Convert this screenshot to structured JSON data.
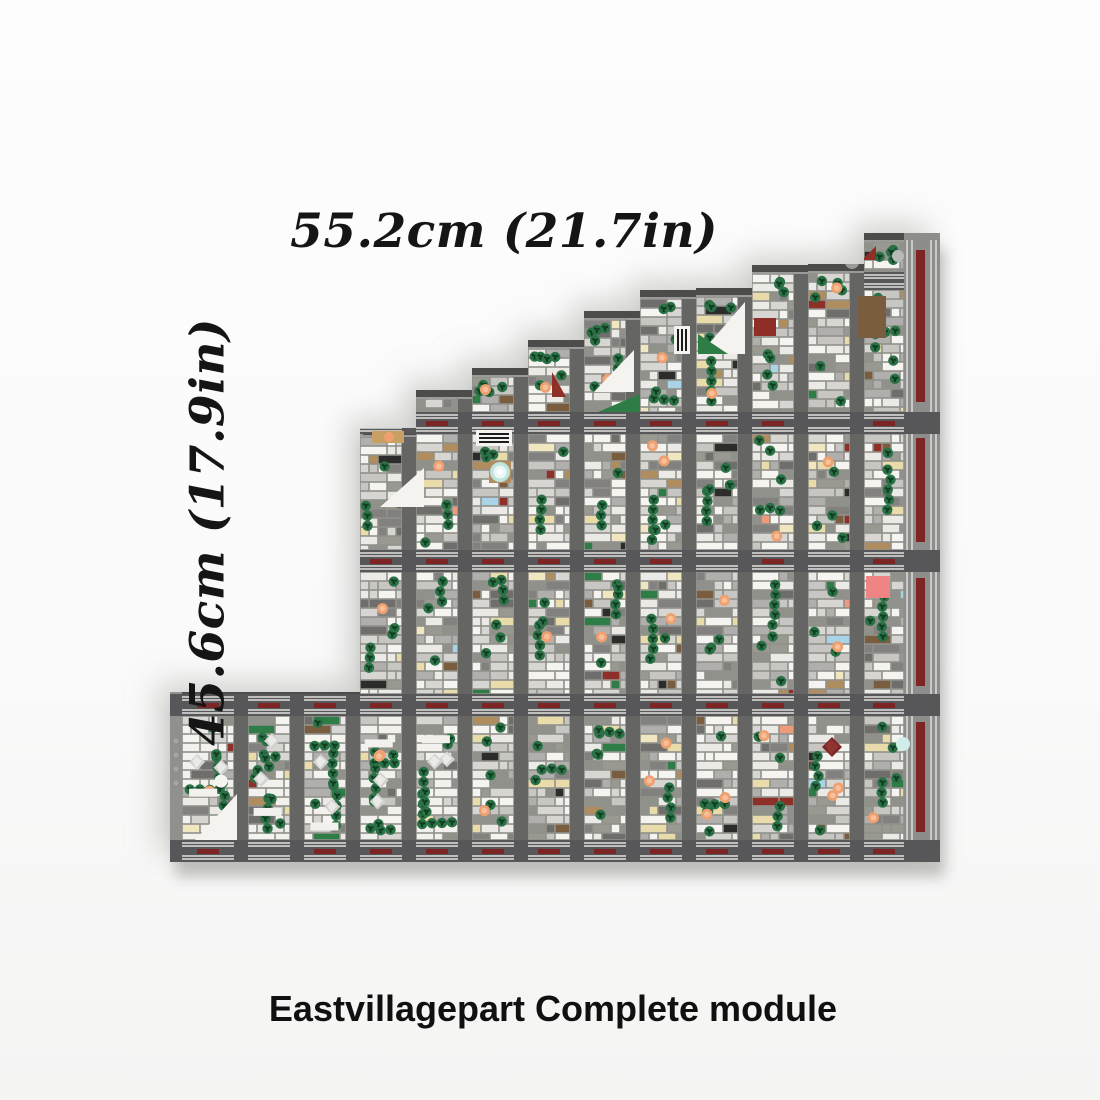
{
  "labels": {
    "width_label": "55.2cm (21.7in)",
    "height_label": "45.6cm (17.9in)",
    "caption": "Eastvillagepart Complete module"
  },
  "model": {
    "description": "Top-down render of stair-stepped LEGO city module with gray streets, white building roofs, green trees, orange dots, red accents",
    "seed": 20,
    "bottom": 862,
    "block_w": 42,
    "street_w": 14,
    "band_h": 22,
    "bands": [
      412,
      550,
      694,
      840
    ],
    "units": [
      {
        "x": 360,
        "w": 56,
        "top": 428
      },
      {
        "x": 416,
        "w": 56,
        "top": 390
      },
      {
        "x": 472,
        "w": 56,
        "top": 368
      },
      {
        "x": 528,
        "w": 56,
        "top": 340
      },
      {
        "x": 584,
        "w": 56,
        "top": 311
      },
      {
        "x": 640,
        "w": 56,
        "top": 290
      },
      {
        "x": 696,
        "w": 56,
        "top": 288
      },
      {
        "x": 752,
        "w": 56,
        "top": 265
      },
      {
        "x": 808,
        "w": 56,
        "top": 264
      },
      {
        "x": 864,
        "w": 76,
        "top": 233
      }
    ],
    "mini_band": {
      "col": 9,
      "y": 272,
      "h": 18
    },
    "extension": {
      "x": 170,
      "w": 190,
      "top": 692,
      "streets": [
        234,
        290,
        346
      ],
      "blocks": [
        [
          182,
          52
        ],
        [
          248,
          42
        ],
        [
          304,
          42
        ]
      ],
      "studs_y": [
        741,
        755,
        769,
        783
      ]
    },
    "platform": {
      "x": 904,
      "w": 36,
      "stripes": [
        906,
        911,
        930,
        935
      ]
    },
    "red_strips": {
      "x": 916,
      "w": 9,
      "segments": [
        [
          250,
          402
        ],
        [
          438,
          542
        ],
        [
          578,
          686
        ],
        [
          722,
          832
        ]
      ]
    },
    "park_max_x": 470,
    "palette": {
      "street": "#656563",
      "street_dark": "#57575a",
      "step_top": "#4c4c4a",
      "step_edge": "#9b9b99",
      "sidewalk": "#8e8e8c",
      "cell_base": "#91918b",
      "stripe": "#bfbfbd",
      "red_bar": "#7c2524",
      "red": "#8e2f28",
      "tree_outer": "#2a7146",
      "tree_dot": "#123c22",
      "orange": "#efa071",
      "orange_core": "#f8c09a",
      "teal": "#bfe4e0",
      "platform_base": "#8d8d8b",
      "platform_stripe": "#c9c9c7",
      "shadow": "#aeaeac",
      "text": "#151515"
    },
    "building_colors": [
      [
        "#f5f4f1",
        20
      ],
      [
        "#eceae6",
        15
      ],
      [
        "#d7d6d3",
        15
      ],
      [
        "#c7c6c3",
        10
      ],
      [
        "#b0afad",
        11
      ],
      [
        "#9a9991",
        6
      ],
      [
        "#82817f",
        7
      ],
      [
        "#6f6e6c",
        4
      ],
      [
        "#e9dcaa",
        5
      ],
      [
        "#b08d5f",
        2
      ],
      [
        "#7a5c3e",
        1.5
      ],
      [
        "#2e7d46",
        2
      ],
      [
        "#2c2c2a",
        1
      ],
      [
        "#8e2f28",
        1
      ],
      [
        "#f0e6c0",
        1.5
      ],
      [
        "#a9d3e6",
        0.5
      ],
      [
        "#ef9a7a",
        0.8
      ]
    ],
    "landmarks": {
      "triangles_white": [
        [
          594,
          392,
          634,
          392,
          634,
          350
        ],
        [
          745,
          302,
          745,
          354,
          700,
          354
        ],
        [
          380,
          507,
          424,
          507,
          424,
          468
        ],
        [
          195,
          840,
          237,
          840,
          237,
          794
        ]
      ],
      "triangles_green": [
        [
          598,
          412,
          640,
          412,
          640,
          394
        ],
        [
          698,
          354,
          728,
          354,
          698,
          334
        ]
      ],
      "triangles_red": [
        [
          552,
          397,
          566,
          397,
          552,
          372
        ],
        [
          862,
          260,
          876,
          246,
          876,
          260
        ]
      ],
      "rects": [
        {
          "x": 372,
          "y": 431,
          "w": 32,
          "h": 12,
          "c": "#c9a063"
        },
        {
          "x": 858,
          "y": 296,
          "w": 28,
          "h": 42,
          "c": "#7a5c3e"
        },
        {
          "x": 754,
          "y": 318,
          "w": 22,
          "h": 18,
          "c": "#8e2f28"
        },
        {
          "x": 866,
          "y": 576,
          "w": 24,
          "h": 22,
          "c": "#ef8484"
        },
        {
          "x": 489,
          "y": 461,
          "w": 22,
          "h": 22,
          "c": "#b08d5f"
        }
      ],
      "fountain": {
        "cx": 500,
        "cy": 472,
        "r": 10
      },
      "diamond_red": {
        "cx": 832,
        "cy": 747,
        "s": 10
      },
      "dots": [
        {
          "cx": 389,
          "cy": 437,
          "r": 5,
          "c": "#efa071"
        },
        {
          "cx": 903,
          "cy": 744,
          "r": 7,
          "c": "#cfeeea"
        },
        {
          "cx": 221,
          "cy": 781,
          "r": 6.5,
          "c": "#f6f5f2"
        },
        {
          "cx": 852,
          "cy": 262,
          "r": 7,
          "c": "#9a9a98"
        },
        {
          "cx": 898,
          "cy": 256,
          "r": 6,
          "c": "#b9b9b7"
        }
      ],
      "vents": [
        {
          "x": 476,
          "y": 430,
          "w": 36,
          "h": 16,
          "dir": "h"
        },
        {
          "x": 674,
          "y": 326,
          "w": 16,
          "h": 28,
          "dir": "v"
        }
      ]
    },
    "density": {
      "park_trees": 14,
      "cell_trees_min": 3,
      "cell_trees_max": 7
    }
  }
}
